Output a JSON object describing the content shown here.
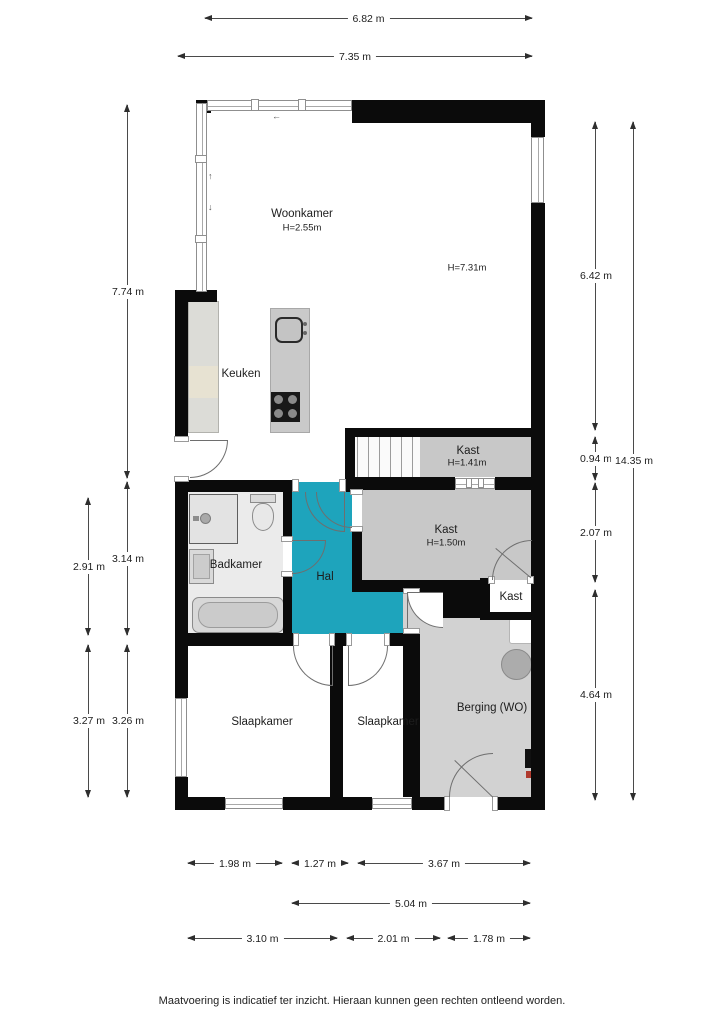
{
  "rooms": {
    "woonkamer": {
      "name": "Woonkamer",
      "ceiling": "H=2.55m",
      "note": "H=7.31m"
    },
    "keuken": {
      "name": "Keuken"
    },
    "kast_stair": {
      "name": "Kast",
      "ceiling": "H=1.41m"
    },
    "kast_main": {
      "name": "Kast",
      "ceiling": "H=1.50m"
    },
    "kast_small": {
      "name": "Kast"
    },
    "badkamer": {
      "name": "Badkamer"
    },
    "hal": {
      "name": "Hal"
    },
    "slaapkamer_left": {
      "name": "Slaapkamer"
    },
    "slaapkamer_mid": {
      "name": "Slaapkamer"
    },
    "berging": {
      "name": "Berging (WO)"
    }
  },
  "dimensions": {
    "top": [
      {
        "label": "6.82 m"
      },
      {
        "label": "7.35 m"
      }
    ],
    "left": [
      {
        "label": "7.74 m"
      },
      {
        "label": "3.14 m"
      },
      {
        "label": "2.91 m"
      },
      {
        "label": "3.27 m"
      },
      {
        "label": "3.26 m"
      }
    ],
    "right": [
      {
        "label": "6.42 m"
      },
      {
        "label": "0.94 m"
      },
      {
        "label": "2.07 m"
      },
      {
        "label": "4.64 m"
      },
      {
        "label": "14.35 m"
      }
    ],
    "bottom": [
      {
        "label": "1.98 m"
      },
      {
        "label": "1.27 m"
      },
      {
        "label": "3.67 m"
      },
      {
        "label": "5.04 m"
      },
      {
        "label": "3.10 m"
      },
      {
        "label": "2.01 m"
      },
      {
        "label": "1.78 m"
      }
    ]
  },
  "icons": {
    "arrow_left": "←",
    "arrow_up": "↑",
    "arrow_down": "↓"
  },
  "colors": {
    "hal_accent": "#1EA4BC",
    "wall": "#0B0B0B",
    "closet_floor": "#C8C8C8",
    "berging_floor": "#D2D2D2",
    "bathroom_floor": "#EBEBEB"
  },
  "footer": {
    "disclaimer": "Maatvoering is indicatief ter inzicht. Hieraan kunnen geen rechten ontleend worden."
  }
}
